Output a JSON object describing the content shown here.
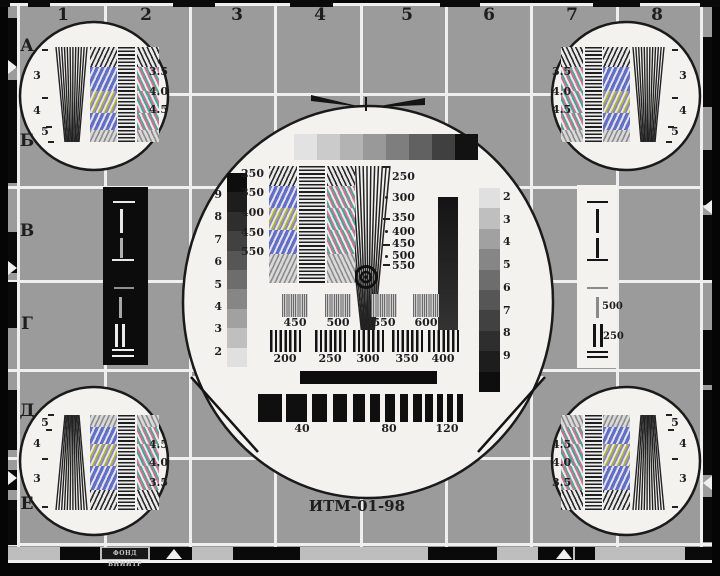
{
  "pattern": {
    "title": "ИТМ-01-98",
    "issuer_mark": "ФОНД ВНИИТР",
    "grid": {
      "columns": [
        "1",
        "2",
        "3",
        "4",
        "5",
        "6",
        "7",
        "8"
      ],
      "rows": [
        "А",
        "Б",
        "В",
        "Г",
        "Д",
        "Е"
      ]
    },
    "corner_resolution_circles": {
      "wedge_labels": [
        "3",
        "4",
        "5"
      ],
      "grating_labels": [
        "3.5",
        "4.0",
        "4.5"
      ]
    },
    "center_circle": {
      "gray_scale_left_labels": [
        "9",
        "8",
        "7",
        "6",
        "5",
        "4",
        "3",
        "2"
      ],
      "gray_scale_right_labels": [
        "2",
        "3",
        "4",
        "5",
        "6",
        "7",
        "8",
        "9"
      ],
      "grating_row_labels": [
        "250",
        "350",
        "400",
        "450",
        "550"
      ],
      "wedge_scale_labels": [
        "250",
        "300",
        "350",
        "400",
        "450",
        "500",
        "550"
      ],
      "fine_burst_labels": [
        "450",
        "500",
        "550",
        "600"
      ],
      "coarse_burst_labels": [
        "200",
        "250",
        "300",
        "350",
        "400"
      ],
      "low_freq_burst_labels": [
        "40",
        "80",
        "120"
      ],
      "pulse_labels": [
        "500",
        "250"
      ]
    },
    "colors": {
      "field_gray": "#9b9b9b",
      "line_white": "#efefef",
      "black": "#0d0d0d",
      "circle_white": "#f3f2ef"
    }
  }
}
